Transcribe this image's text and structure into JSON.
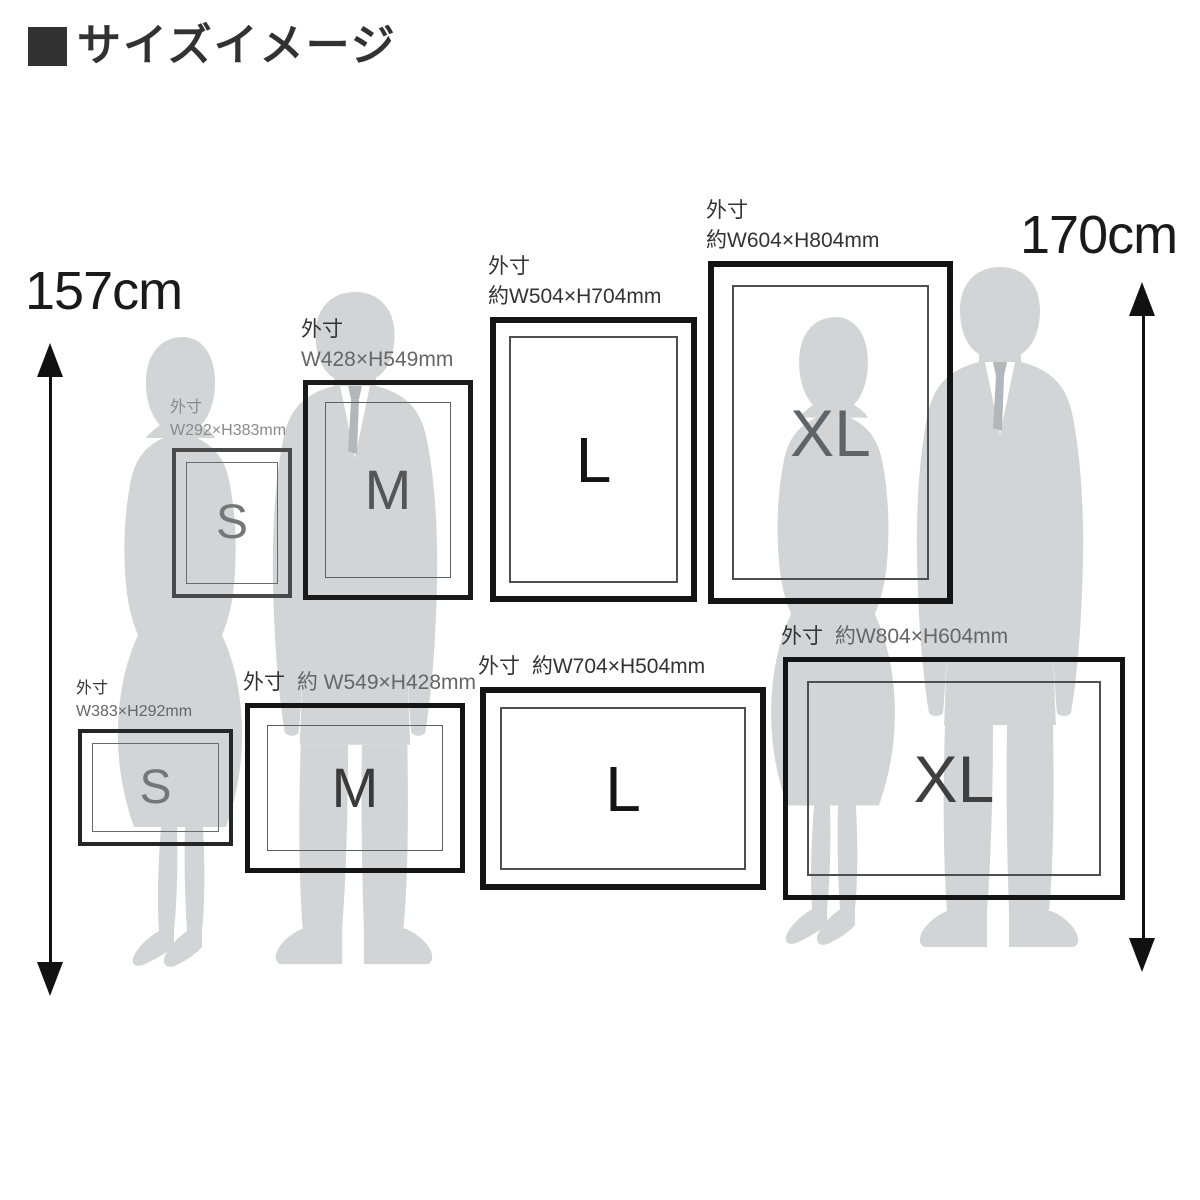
{
  "title": {
    "marker_icon": "black-square",
    "text": "サイズイメージ"
  },
  "scales": {
    "left": {
      "label": "157cm",
      "figure": "woman-silhouette"
    },
    "right": {
      "label": "170cm",
      "figure": "man-silhouette"
    }
  },
  "frames": {
    "portrait": [
      {
        "size": "S",
        "dim_prefix": "外寸",
        "dim_text": "W292×H383mm"
      },
      {
        "size": "M",
        "dim_prefix": "外寸",
        "dim_text": "W428×H549mm"
      },
      {
        "size": "L",
        "dim_prefix": "外寸",
        "dim_text": "約W504×H704mm"
      },
      {
        "size": "XL",
        "dim_prefix": "外寸",
        "dim_text": "約W604×H804mm"
      }
    ],
    "landscape": [
      {
        "size": "S",
        "dim_prefix": "外寸",
        "dim_text": "W383×H292mm"
      },
      {
        "size": "M",
        "dim_prefix": "外寸",
        "dim_text": "約 W549×H428mm"
      },
      {
        "size": "L",
        "dim_prefix": "外寸",
        "dim_text": "約W704×H504mm"
      },
      {
        "size": "XL",
        "dim_prefix": "外寸",
        "dim_text": "約W804×H604mm"
      }
    ]
  },
  "colors": {
    "background": "#ffffff",
    "silhouette": "#d3d4d5",
    "shirt": "#ffffff",
    "tie": "#b4b7ba",
    "frame_border": "#141414",
    "frame_border_s": "#4a4a4a",
    "mat_line": "#4f4f4f",
    "label_dark": "#333333",
    "label_gray": "#8a8a8a",
    "arrow": "#111111",
    "title": "#323232"
  }
}
